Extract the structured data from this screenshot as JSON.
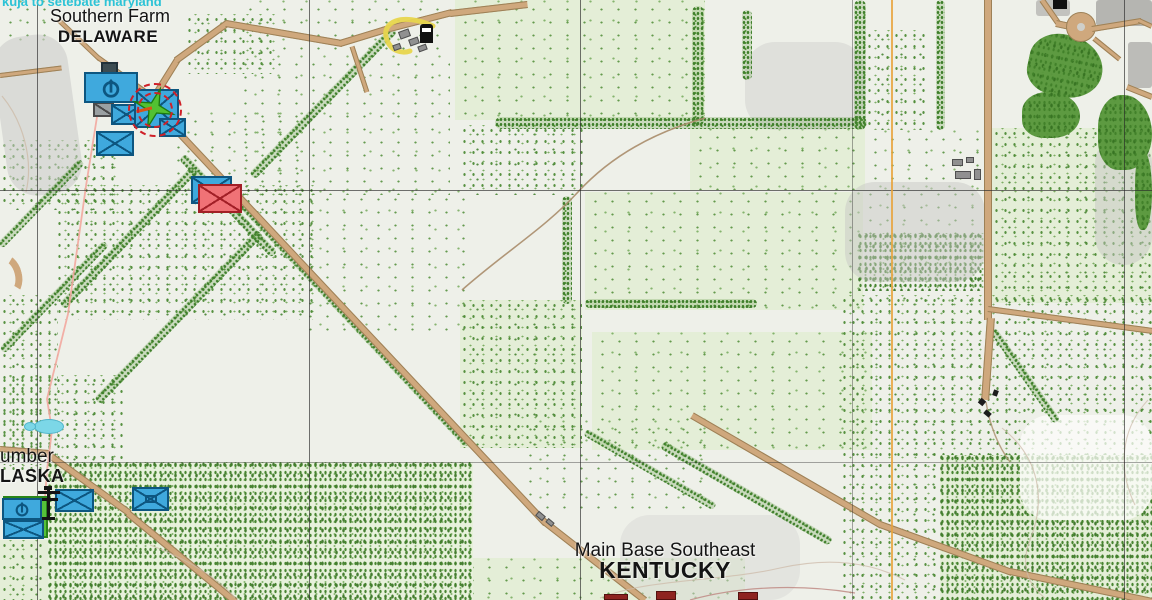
{
  "map_view": {
    "note_marker": {
      "text": "kuja to setebate maryland",
      "color": "#2cc3d6"
    },
    "places": {
      "southern_farm": {
        "title": "Southern Farm",
        "subtitle": "DELAWARE"
      },
      "lumber_alaska": {
        "title": "umber",
        "subtitle": "LASKA"
      },
      "main_base": {
        "title": "Main Base Southeast",
        "subtitle": "KENTUCKY"
      }
    },
    "markers": {
      "blufor_color": "#3fa9dd",
      "opfor_color": "#f07276",
      "delaware_group": [
        "hq-motorized",
        "damaged-unit",
        "infantry",
        "infantry",
        "infantry",
        "infantry"
      ],
      "delaware_objective": {
        "shape": "green-compass-star",
        "ring": "red-dashed-double-circle"
      },
      "contact_pair": {
        "blufor": "infantry",
        "opfor": "infantry"
      },
      "alaska_group": [
        "hq-motorized",
        "infantry",
        "infantry",
        "mechanized-infantry"
      ],
      "alaska_zone": {
        "shape": "green-square"
      }
    },
    "icons": {
      "fuel_station": "fuel-pump",
      "power_pylon": "transmission-tower",
      "town_building": "house"
    },
    "grid": {
      "vertical_x": [
        37,
        309,
        580,
        852,
        1124
      ],
      "horizontal_y": [
        190,
        462
      ]
    },
    "colors": {
      "road": "#cfa87d",
      "water": "#7cd7e7",
      "orange_line": "#e8a33c",
      "powerline": "#f2a79e",
      "grid_line": "#4b4b4b",
      "vegetation": "#4e8c35",
      "objective_ring": "#cf2028",
      "zone_green": "#55c13a"
    }
  }
}
